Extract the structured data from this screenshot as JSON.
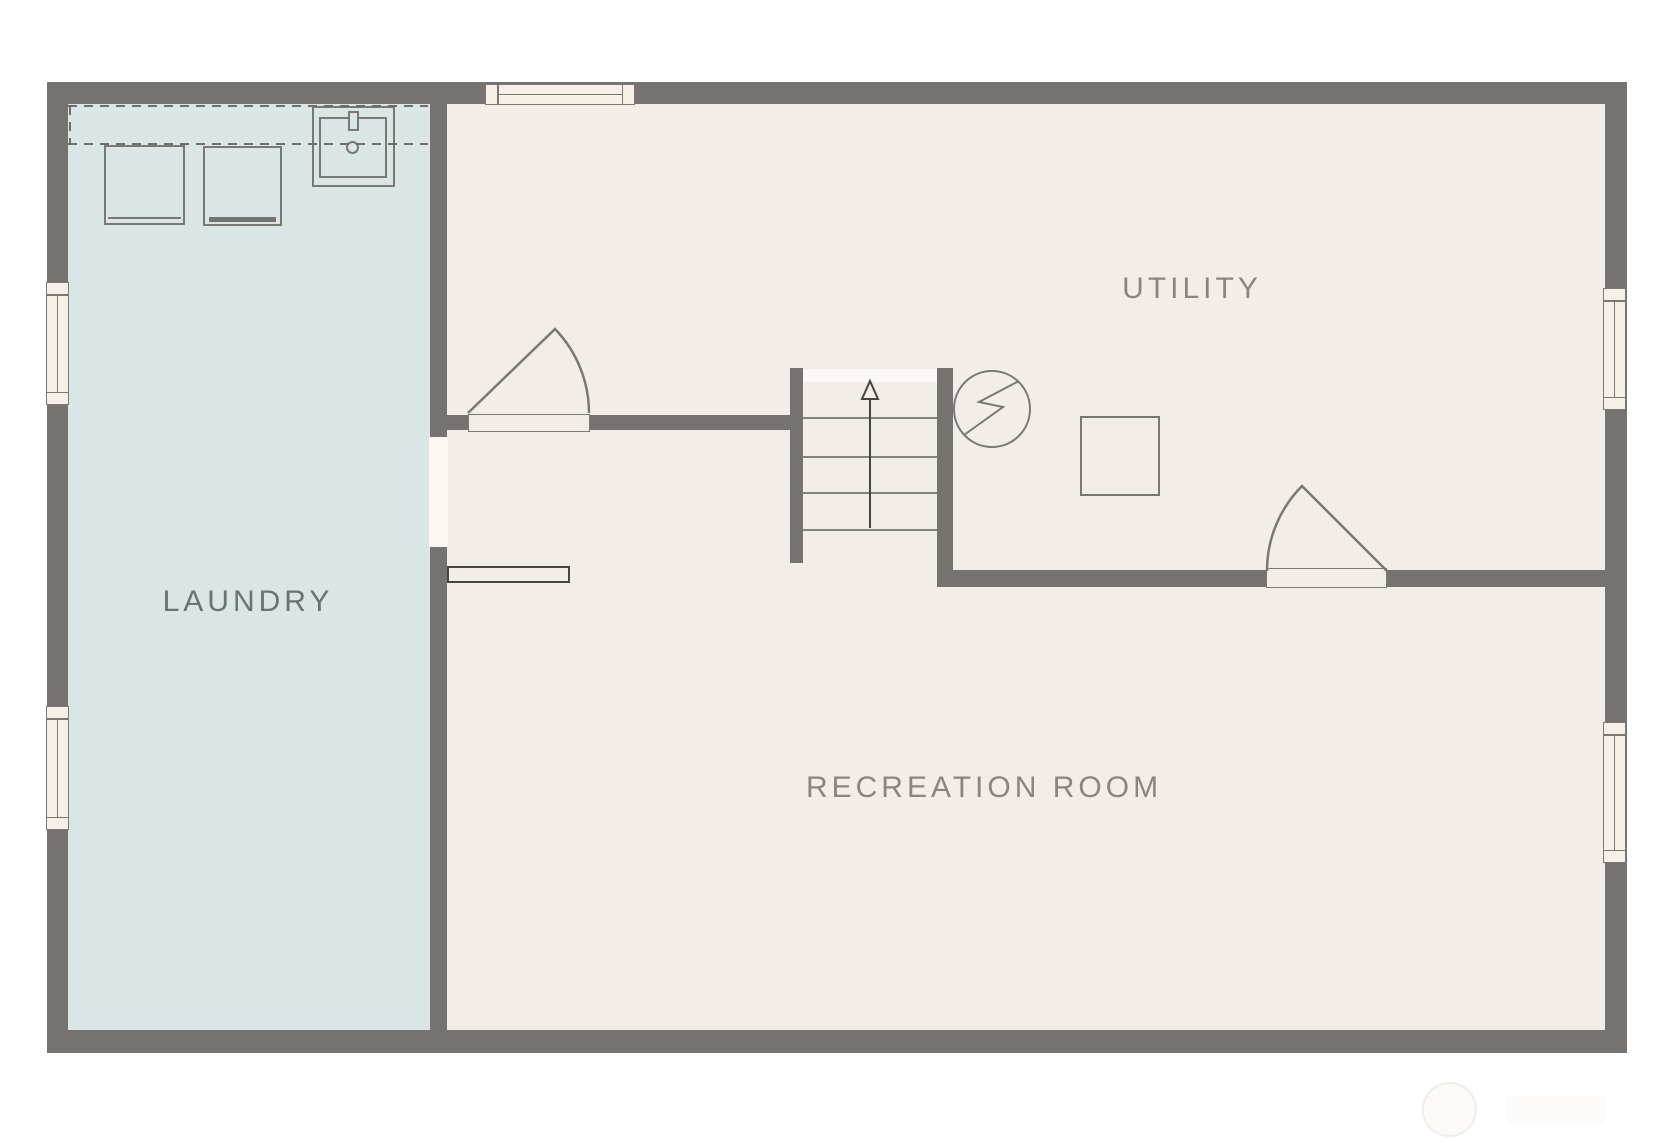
{
  "colors": {
    "wall": "#757270",
    "floor": "#f2ede6",
    "laundry": "#dae5e5",
    "line": "#7b7874",
    "line-dark": "#454543",
    "label": "#8a857e",
    "label-laundry": "#6d7271",
    "window-fill": "#f5efe8",
    "opening-fill": "#fbf8f4",
    "landing": "#fbf9f6",
    "watermark": "#f8f6f3"
  },
  "rooms": {
    "laundry": {
      "label": "LAUNDRY"
    },
    "utility": {
      "label": "UTILITY"
    },
    "recreation": {
      "label": "RECREATION ROOM"
    }
  },
  "fixtures": {
    "washer": "washer",
    "dryer": "dryer",
    "sink": "utility-sink",
    "electrical_panel": "electrical-panel",
    "water_heater": "water-heater",
    "counter": "dashed-counter-outline",
    "stairs": {
      "direction": "up",
      "tread_count": 5
    }
  }
}
